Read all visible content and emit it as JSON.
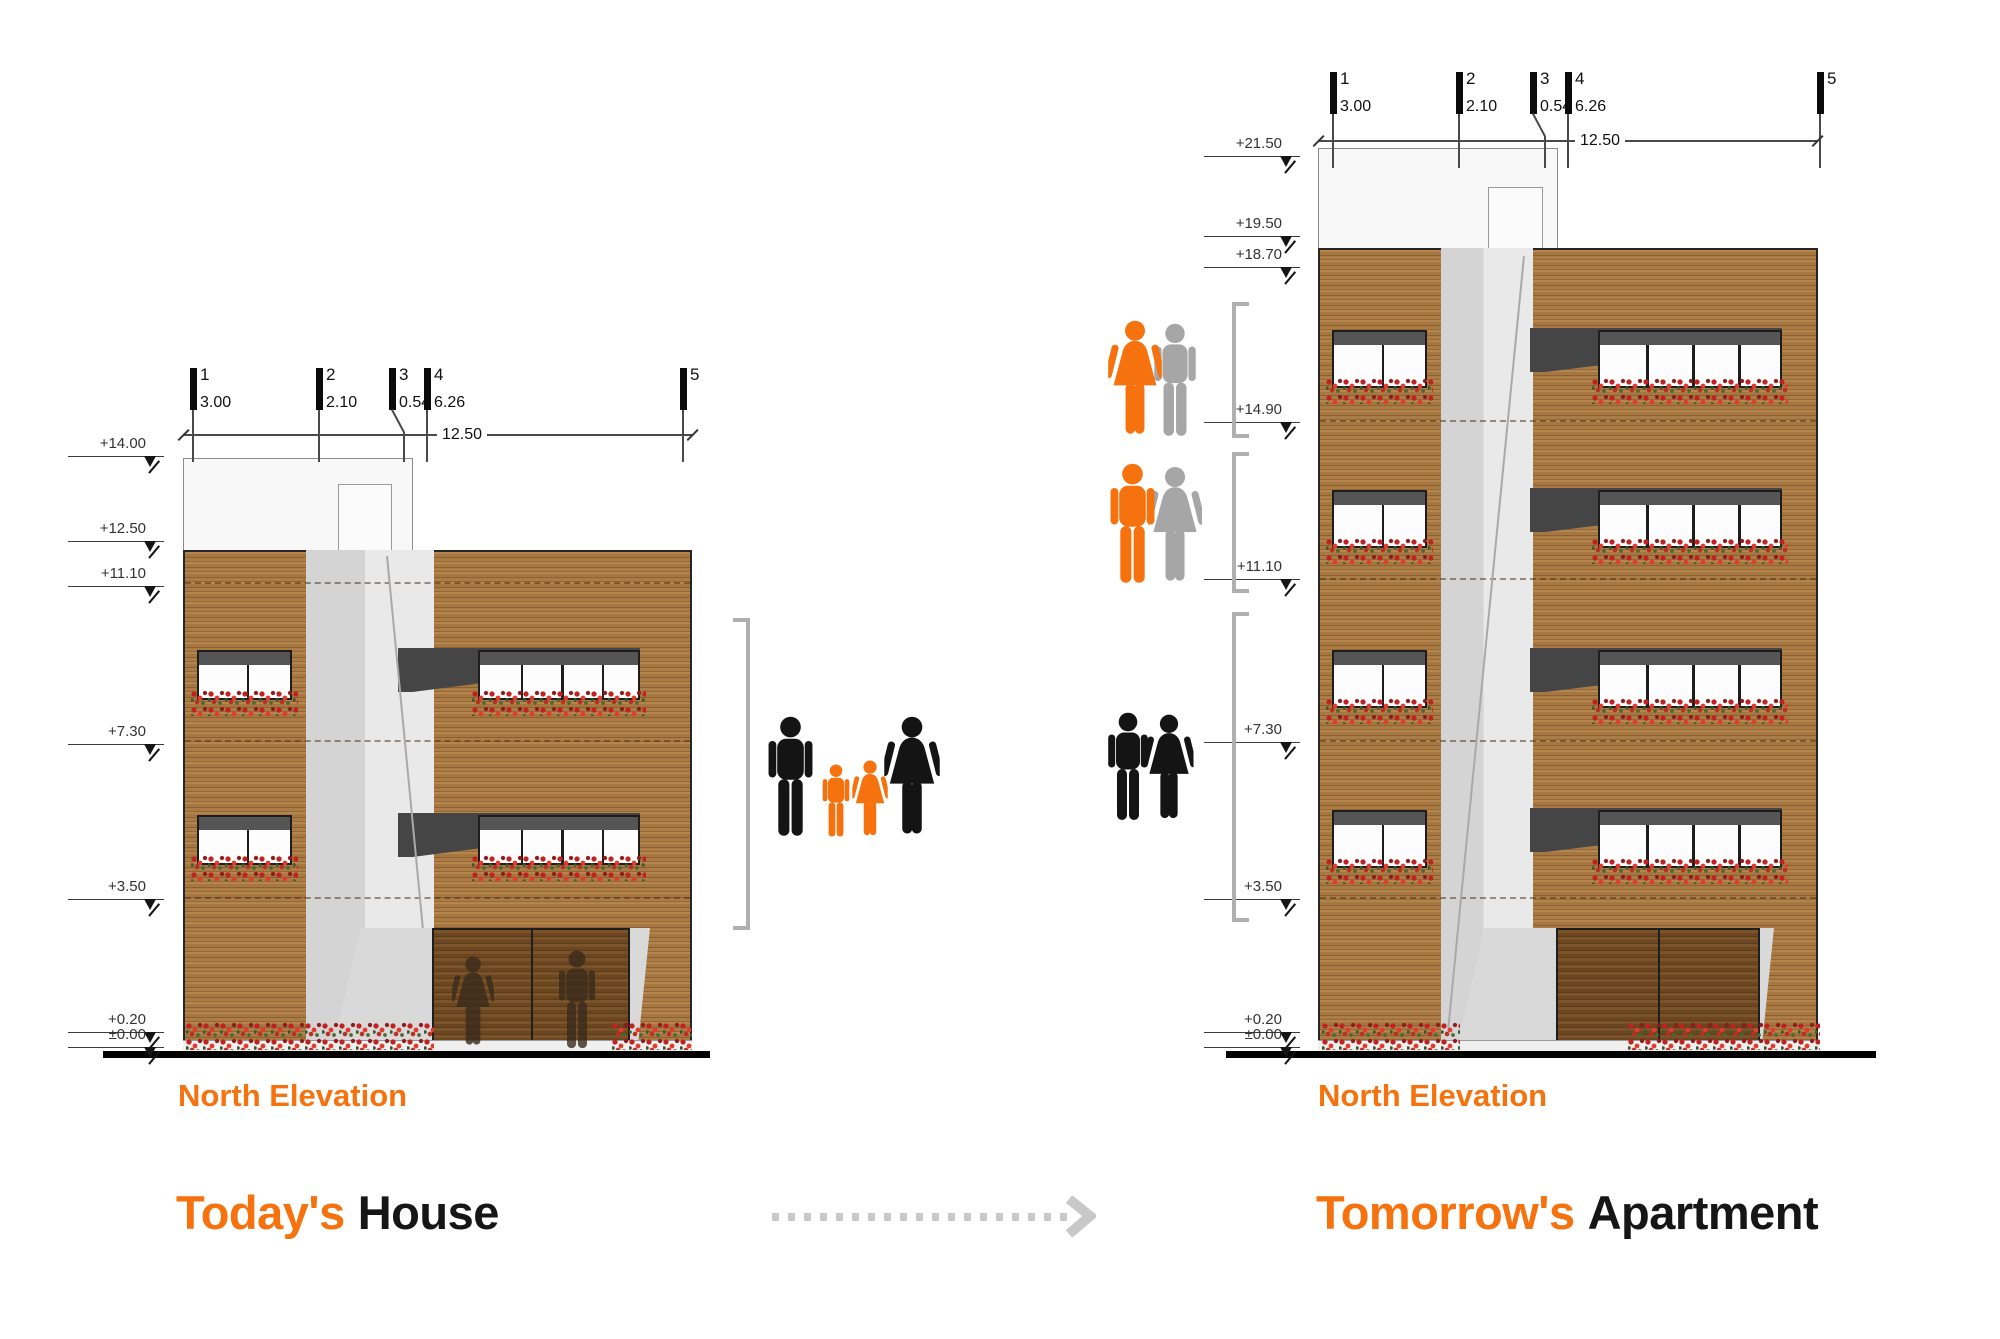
{
  "palette": {
    "orange": "#F5720E",
    "black": "#141414",
    "gray": "#A6A6A6",
    "silhouette": "#3A2B1C",
    "bracket": "#B0B0B0",
    "arrow": "#C8C8C8",
    "wood": "#A57842",
    "level_text": "#333333"
  },
  "left": {
    "north_label": "North Elevation",
    "title_orange": "Today's",
    "title_black": "House",
    "total_dim": "12.50",
    "levels": [
      {
        "label": "+14.00",
        "y": 457
      },
      {
        "label": "+12.50",
        "y": 542
      },
      {
        "label": "+11.10",
        "y": 587
      },
      {
        "label": "+7.30",
        "y": 745
      },
      {
        "label": "+3.50",
        "y": 900
      },
      {
        "label": "+0.20",
        "y": 1033
      },
      {
        "label": "±0.00",
        "y": 1048
      }
    ],
    "grids": [
      {
        "n": "1",
        "dim": "3.00",
        "x": 190,
        "jog": false
      },
      {
        "n": "2",
        "dim": "2.10",
        "x": 316,
        "jog": false
      },
      {
        "n": "3",
        "dim": "0.54",
        "x": 389,
        "jog": true
      },
      {
        "n": "4",
        "dim": "6.26",
        "x": 424,
        "jog": false
      },
      {
        "n": "5",
        "dim": "",
        "x": 680,
        "jog": false
      }
    ]
  },
  "right": {
    "north_label": "North Elevation",
    "title_orange": "Tomorrow's",
    "title_black": "Apartment",
    "total_dim": "12.50",
    "levels": [
      {
        "label": "+21.50",
        "y": 157
      },
      {
        "label": "+19.50",
        "y": 237
      },
      {
        "label": "+18.70",
        "y": 268
      },
      {
        "label": "+14.90",
        "y": 423
      },
      {
        "label": "+11.10",
        "y": 580
      },
      {
        "label": "+7.30",
        "y": 743
      },
      {
        "label": "+3.50",
        "y": 900
      },
      {
        "label": "+0.20",
        "y": 1033
      },
      {
        "label": "±0.00",
        "y": 1048
      }
    ],
    "grids": [
      {
        "n": "1",
        "dim": "3.00",
        "x": 1330,
        "jog": false
      },
      {
        "n": "2",
        "dim": "2.10",
        "x": 1456,
        "jog": false
      },
      {
        "n": "3",
        "dim": "0.54",
        "x": 1530,
        "jog": true
      },
      {
        "n": "4",
        "dim": "6.26",
        "x": 1565,
        "jog": false
      },
      {
        "n": "5",
        "dim": "",
        "x": 1817,
        "jog": false
      }
    ]
  },
  "layout": {
    "left": {
      "level_x": 164,
      "grid": {
        "bar_y": 368,
        "line_to": 462
      },
      "dim": {
        "y": 434,
        "x1": 183,
        "x2": 692,
        "cx": 462
      },
      "windows": {
        "rows": [
          650,
          815
        ],
        "win_h": 50,
        "small": {
          "x": 197,
          "w": 95,
          "panes": 2
        },
        "wide": {
          "x": 478,
          "w": 162,
          "panes": 4
        },
        "soffit": {
          "x": 398,
          "w": 242
        }
      }
    },
    "right": {
      "level_x": 1300,
      "grid": {
        "bar_y": 72,
        "line_to": 168
      },
      "dim": {
        "y": 140,
        "x1": 1318,
        "x2": 1817,
        "cx": 1600
      },
      "windows": {
        "rows": [
          330,
          490,
          650,
          810
        ],
        "win_h": 58,
        "small": {
          "x": 1332,
          "w": 95,
          "panes": 2
        },
        "wide": {
          "x": 1598,
          "w": 184,
          "panes": 4
        },
        "soffit": {
          "x": 1530,
          "w": 252
        }
      }
    },
    "rects_back": [
      {
        "cls": "parapet",
        "name": "left-roof-parapet",
        "x": 183,
        "y": 458,
        "w": 230,
        "h": 94
      },
      {
        "cls": "pdoor",
        "name": "left-roof-door",
        "x": 338,
        "y": 484,
        "w": 54,
        "h": 68
      },
      {
        "cls": "wood",
        "name": "left-facade",
        "x": 183,
        "y": 550,
        "w": 509,
        "h": 502
      },
      {
        "cls": "wedge",
        "name": "left-stair-wedge",
        "x": 306,
        "y": 550,
        "w": 128,
        "h": 502
      },
      {
        "cls": "parapet",
        "name": "right-roof-parapet",
        "x": 1318,
        "y": 148,
        "w": 240,
        "h": 102
      },
      {
        "cls": "pdoor",
        "name": "right-roof-door",
        "x": 1488,
        "y": 187,
        "w": 55,
        "h": 63
      },
      {
        "cls": "wood",
        "name": "right-facade",
        "x": 1318,
        "y": 248,
        "w": 500,
        "h": 804
      },
      {
        "cls": "wedge",
        "name": "right-stair-wedge",
        "x": 1441,
        "y": 248,
        "w": 92,
        "h": 804
      }
    ],
    "joints": [
      {
        "x": 185,
        "y": 582,
        "w": 505
      },
      {
        "x": 185,
        "y": 740,
        "w": 505
      },
      {
        "x": 185,
        "y": 897,
        "w": 505
      },
      {
        "x": 1320,
        "y": 420,
        "w": 496
      },
      {
        "x": 1320,
        "y": 578,
        "w": 496
      },
      {
        "x": 1320,
        "y": 740,
        "w": 496
      },
      {
        "x": 1320,
        "y": 897,
        "w": 496
      }
    ],
    "diagonals": [
      {
        "name": "left-wedge-edge",
        "x": 386,
        "y": 556,
        "len": 478,
        "rot": -5.5
      },
      {
        "name": "right-wedge-edge",
        "x": 1523,
        "y": 256,
        "len": 776,
        "rot": 5.6
      }
    ],
    "rects_front": [
      {
        "cls": "entr",
        "name": "left-entrance-recess",
        "x": 332,
        "y": 928,
        "w": 318,
        "h": 124
      },
      {
        "cls": "door",
        "name": "left-entrance-door",
        "x": 432,
        "y": 928,
        "w": 198,
        "h": 124
      },
      {
        "cls": "entr",
        "name": "right-entrance-recess",
        "x": 1456,
        "y": 928,
        "w": 318,
        "h": 124
      },
      {
        "cls": "door",
        "name": "right-entrance-door",
        "x": 1556,
        "y": 928,
        "w": 204,
        "h": 124
      },
      {
        "cls": "planter",
        "name": "left-planter-base",
        "x": 183,
        "y": 1040,
        "w": 509,
        "h": 12
      },
      {
        "cls": "planter",
        "name": "right-planter-base",
        "x": 1318,
        "y": 1040,
        "w": 500,
        "h": 12
      },
      {
        "cls": "flowers",
        "name": "left-ground-flowers",
        "x": 186,
        "y": 1022,
        "w": 248,
        "h": 28
      },
      {
        "cls": "flowers",
        "name": "left-ground-flowers",
        "x": 612,
        "y": 1022,
        "w": 80,
        "h": 28
      },
      {
        "cls": "flowers",
        "name": "right-ground-flowers",
        "x": 1322,
        "y": 1022,
        "w": 138,
        "h": 28
      },
      {
        "cls": "flowers",
        "name": "right-ground-flowers",
        "x": 1628,
        "y": 1022,
        "w": 192,
        "h": 28
      },
      {
        "cls": "ground",
        "name": "left-ground-line",
        "x": 103,
        "y": 1051,
        "w": 607,
        "h": 7
      },
      {
        "cls": "ground",
        "name": "right-ground-line",
        "x": 1226,
        "y": 1051,
        "w": 650,
        "h": 7
      }
    ],
    "brackets": [
      {
        "name": "bracket-family-floors",
        "x": 746,
        "y": 618,
        "h": 312,
        "dir": "left"
      },
      {
        "name": "bracket-top-floor",
        "x": 1232,
        "y": 302,
        "h": 136,
        "dir": "right"
      },
      {
        "name": "bracket-mid-floor",
        "x": 1232,
        "y": 452,
        "h": 141,
        "dir": "right"
      },
      {
        "name": "bracket-lower-floors",
        "x": 1232,
        "y": 612,
        "h": 310,
        "dir": "right"
      }
    ],
    "silhouettes": [
      {
        "icon": "woman",
        "x": 452,
        "y": 956,
        "w": 42,
        "h": 92
      },
      {
        "icon": "man",
        "x": 556,
        "y": 950,
        "w": 42,
        "h": 100
      }
    ],
    "titles": {
      "left_north": {
        "x": 178,
        "y": 1078
      },
      "left_title": {
        "x": 176,
        "y": 1185
      },
      "right_north": {
        "x": 1318,
        "y": 1078
      },
      "right_title": {
        "x": 1316,
        "y": 1185
      }
    },
    "arrow": {
      "x": 772,
      "y": 1213,
      "w": 296,
      "head_x": 1066,
      "head_y": 1196
    }
  },
  "people_groups": [
    {
      "name": "family-todays-house",
      "x": 766,
      "y": 716,
      "h": 122,
      "members": [
        {
          "icon": "man",
          "color": "black",
          "dx": 0,
          "w": 49,
          "h": 122
        },
        {
          "icon": "man",
          "color": "orange",
          "dx": 55,
          "w": 30,
          "h": 74
        },
        {
          "icon": "woman",
          "color": "orange",
          "dx": 86,
          "w": 36,
          "h": 78
        },
        {
          "icon": "woman",
          "color": "black",
          "dx": 118,
          "w": 56,
          "h": 122
        }
      ]
    },
    {
      "name": "couple-top-floor",
      "x": 1108,
      "y": 320,
      "h": 118,
      "members": [
        {
          "icon": "man",
          "color": "gray",
          "dx": 44,
          "w": 46,
          "h": 116
        },
        {
          "icon": "woman",
          "color": "orange",
          "dx": 0,
          "w": 54,
          "h": 118
        }
      ]
    },
    {
      "name": "couple-mid-floor",
      "x": 1108,
      "y": 463,
      "h": 122,
      "members": [
        {
          "icon": "woman",
          "color": "gray",
          "dx": 40,
          "w": 54,
          "h": 120
        },
        {
          "icon": "man",
          "color": "orange",
          "dx": 0,
          "w": 49,
          "h": 122
        }
      ]
    },
    {
      "name": "couple-lower-floors",
      "x": 1106,
      "y": 712,
      "h": 110,
      "members": [
        {
          "icon": "woman",
          "color": "black",
          "dx": 38,
          "w": 50,
          "h": 108
        },
        {
          "icon": "man",
          "color": "black",
          "dx": 0,
          "w": 44,
          "h": 110
        }
      ]
    }
  ]
}
